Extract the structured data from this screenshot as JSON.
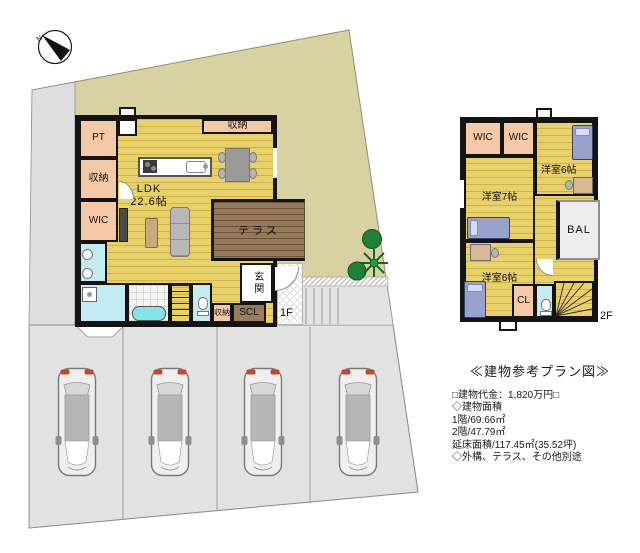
{
  "compass": {
    "n": "N"
  },
  "floor1": {
    "label": "1F",
    "rooms": {
      "pt": "PT",
      "storage_left": "収納",
      "wic": "WIC",
      "storage_top": "収納",
      "ldk_name": "LDK",
      "ldk_size": "22.6帖",
      "terrace": "テラス",
      "entrance": "玄関",
      "scl": "SCL",
      "storage_small": "収納"
    }
  },
  "floor2": {
    "label": "2F",
    "rooms": {
      "wic1": "WIC",
      "wic2": "WIC",
      "bedroom6_top": "洋室6帖",
      "bedroom7": "洋室7帖",
      "balcony": "BAL",
      "bedroom6_bottom": "洋室6帖",
      "cl": "CL"
    }
  },
  "info": {
    "title": "≪建物参考プラン図≫",
    "price": "□建物代金：1,820万円□",
    "area_heading": "◇建物面積",
    "area_f1": "1階/69.66㎡",
    "area_f2": "2階/47.79㎡",
    "area_total": "延床面積/117.45㎡(35.52坪)",
    "note": "◇外構、テラス、その他別途"
  },
  "parking": {
    "stall_count": 4,
    "car_count": 4
  },
  "colors": {
    "site_fill": "#d8d1a2",
    "parking_fill": "#e2e2e2",
    "wall": "#141414",
    "room_pink": "#f6c9a6",
    "water_cyan": "#c2ecf2",
    "terrace_brown": "#96785a",
    "floor_yellow": "#e9d169",
    "plant_green": "#1f8038",
    "car_taillight_red": "#c2472e"
  }
}
